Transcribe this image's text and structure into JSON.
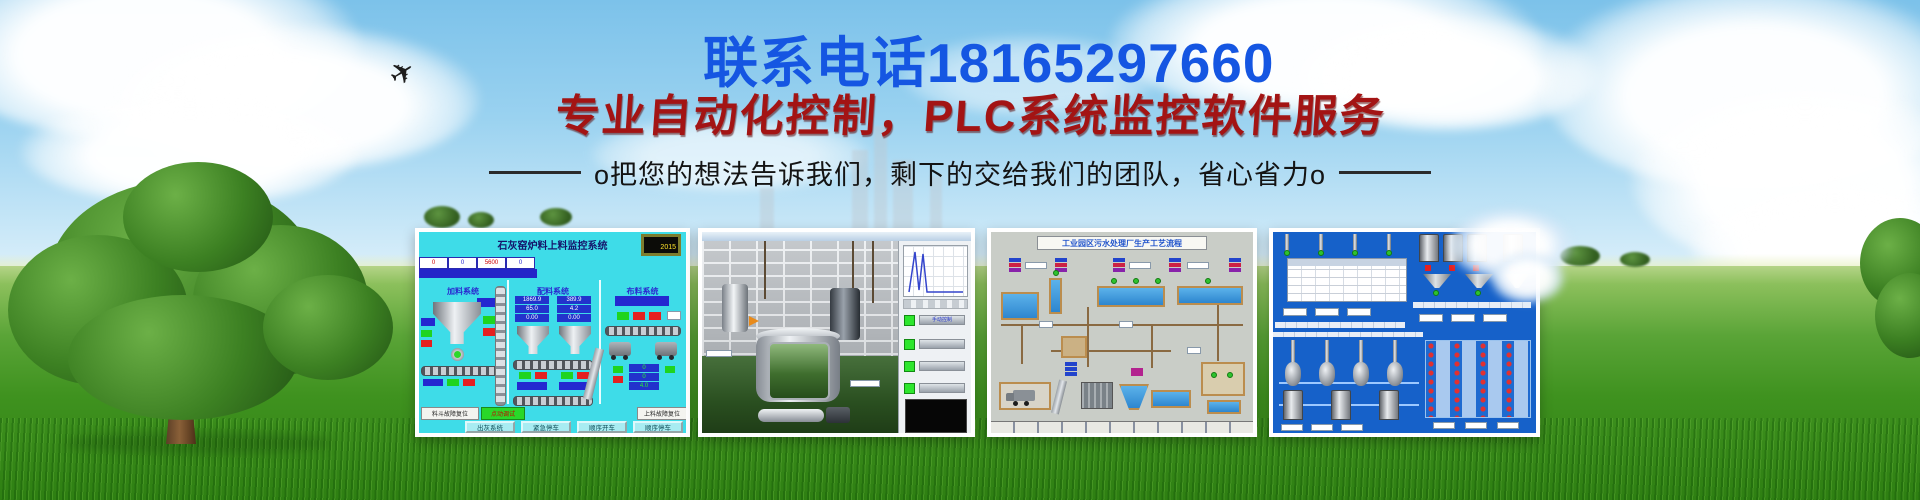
{
  "banner": {
    "phone_line": "联系电话18165297660",
    "headline": "专业自动化控制，PLC系统监控软件服务",
    "subtitle": "o把您的想法告诉我们，剩下的交给我们的团队，省心省力o"
  },
  "icons": {
    "airplane": "✈"
  },
  "colors": {
    "phone_blue": "#1556e2",
    "headline_red": "#a31414",
    "subtitle_black": "#141414",
    "hmi_cyan": "#3edce8",
    "hmi_blue": "#1661c9",
    "grass_green": "#3f921f",
    "sky_blue": "#8ecbec"
  },
  "screens": {
    "lime_kiln": {
      "title": "石灰窑炉料上料监控系统",
      "clock": "2015",
      "header_values": [
        "0",
        "0",
        "5600",
        "0"
      ],
      "sections": [
        "加料系统",
        "配料系统",
        "布料系统"
      ],
      "readout_a": [
        "1869.9",
        "65.0",
        "0.00"
      ],
      "readout_b": [
        "389.9",
        "4.2",
        "0.00"
      ],
      "readout_c": [
        "0",
        "0",
        "4.0"
      ],
      "btn_reset_left": "料斗故障复位",
      "btn_jog": "点动调试",
      "btn_reset_right": "上料故障复位",
      "footer_buttons": [
        "出灰系统",
        "紧急停车",
        "顺序开车",
        "顺序停车"
      ]
    },
    "mixing_plant": {
      "panel_label": "手动控制"
    },
    "sewage_plant": {
      "title": "工业园区污水处理厂生产工艺流程"
    }
  }
}
